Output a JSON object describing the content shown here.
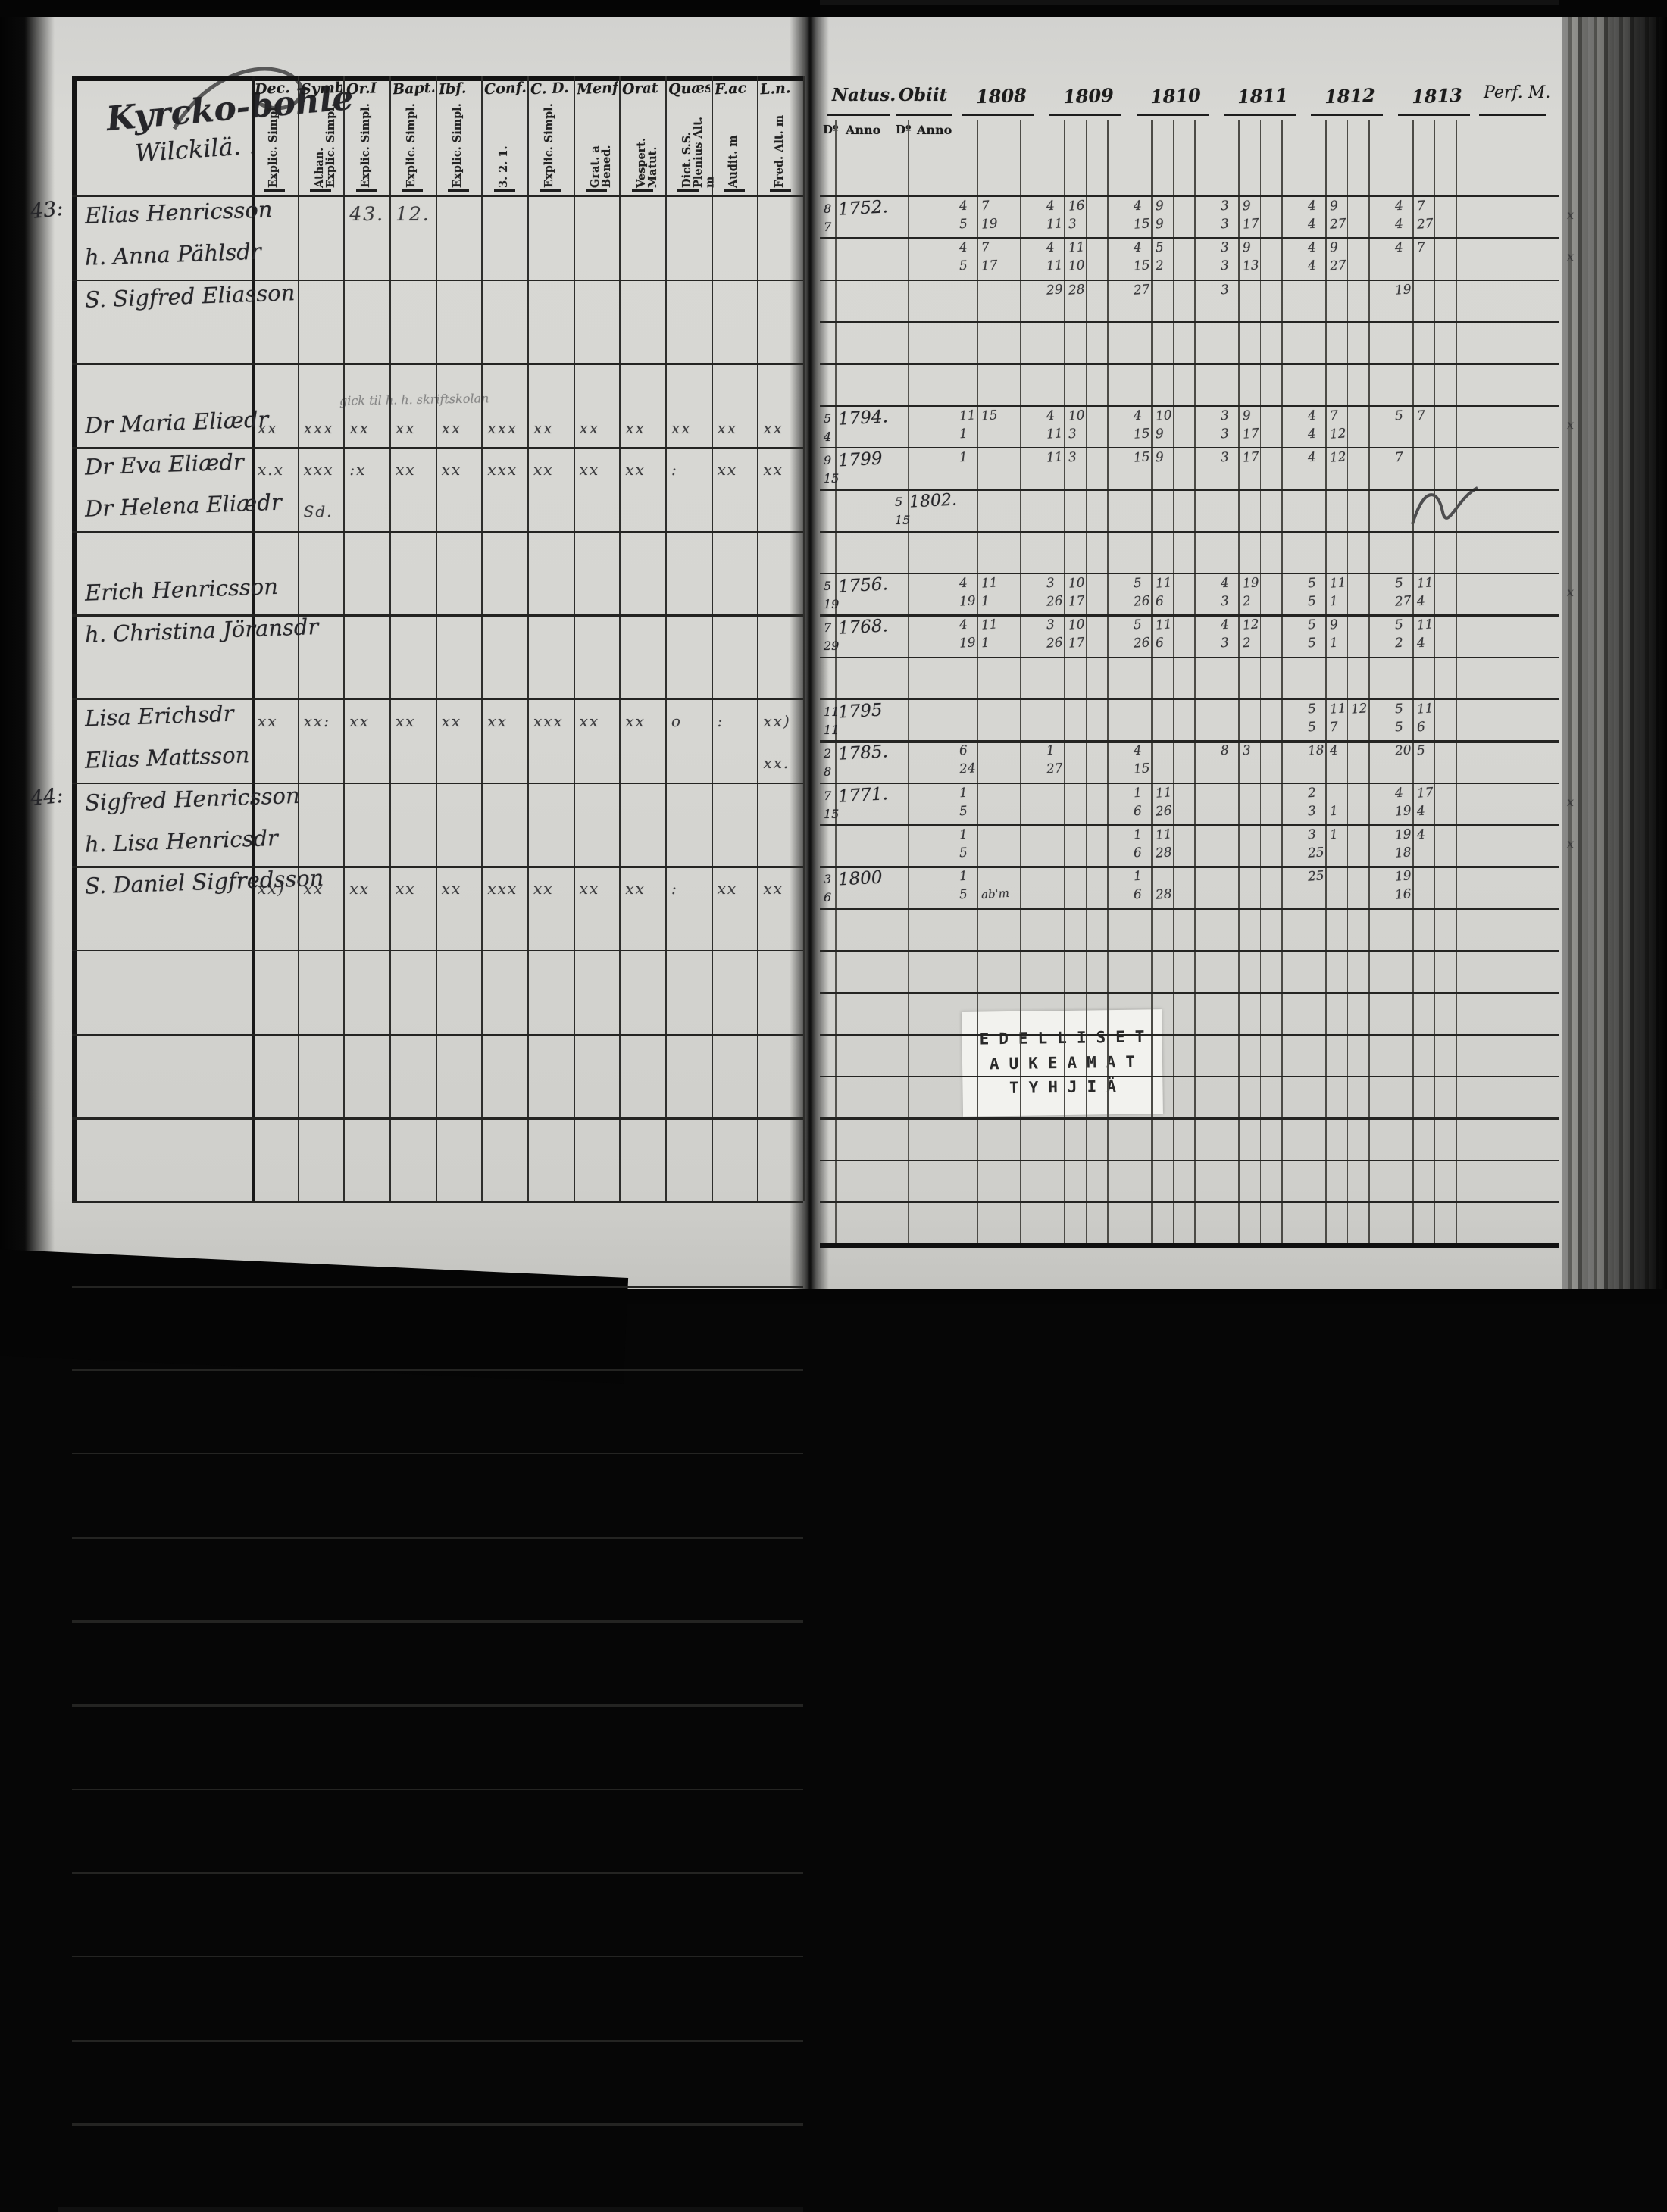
{
  "colors": {
    "paper": "#d6d6d2",
    "ink": "#1b1b1b",
    "hand": "#26262a",
    "stamp_bg": "#f2f2ee"
  },
  "left_page": {
    "title1": "Kyrcko-bohle",
    "title2": "Wilckilä. .",
    "columns": [
      {
        "abbr": "Dec.",
        "sub": "Explic. Simpl."
      },
      {
        "abbr": "Symb.",
        "sub": "Athan. Explic. Simpl."
      },
      {
        "abbr": "Or.I",
        "sub": "Explic. Simpl."
      },
      {
        "abbr": "Bapt.",
        "sub": "Explic. Simpl."
      },
      {
        "abbr": "Ibf.",
        "sub": "Explic. Simpl."
      },
      {
        "abbr": "Conf.",
        "sub": "3. 2. 1."
      },
      {
        "abbr": "C. D.",
        "sub": "Explic. Simpl."
      },
      {
        "abbr": "Menf.",
        "sub": "Grat. a Bened."
      },
      {
        "abbr": "Orat",
        "sub": "Vespert. Matut."
      },
      {
        "abbr": "Quæst.",
        "sub": "Dict. S.S. Plenius Alt. m"
      },
      {
        "abbr": "F.ac",
        "sub": "Audit. m"
      },
      {
        "abbr": "L.n.",
        "sub": "Fred. Alt. m"
      }
    ]
  },
  "right_page": {
    "natus_label": "Natus.",
    "obiit_label": "Obiit",
    "do_label": "Dº",
    "anno_label": "Anno",
    "years": [
      "1808",
      "1809",
      "1810",
      "1811",
      "1812",
      "1813"
    ],
    "perf_label": "Perf. M.",
    "stamp": [
      "EDELLISET",
      "AUKEAMAT",
      "TYHJIÄ"
    ]
  },
  "entries": [
    {
      "row": 0,
      "margin": "43:",
      "name": "Elias Henricsson",
      "left_marks": {
        "2": "43.",
        "3": "12."
      },
      "natus": {
        "d": "8",
        "y": "1752.",
        "d2": "7"
      },
      "cells": {
        "1808": {
          "t": "4 7",
          "b": "5 19"
        },
        "1809": {
          "t": "4 16",
          "b": "11 3"
        },
        "1810": {
          "t": "4 9",
          "b": "15 9"
        },
        "1811": {
          "t": "3 9",
          "b": "3 17"
        },
        "1812": {
          "t": "4 9",
          "b": "4 27"
        },
        "1813": {
          "t": "4 7",
          "b": "4 27"
        }
      },
      "edge_mark": "x"
    },
    {
      "row": 1,
      "name": "h. Anna Pählsdr",
      "cells": {
        "1808": {
          "t": "4 7",
          "b": "5 17"
        },
        "1809": {
          "t": "4 11",
          "b": "11 10"
        },
        "1810": {
          "t": "4 5",
          "b": "15 2"
        },
        "1811": {
          "t": "3 9",
          "b": "3 13"
        },
        "1812": {
          "t": "4 9",
          "b": "4 27"
        },
        "1813": {
          "t": "4 7",
          "b": ""
        }
      },
      "edge_mark": "x"
    },
    {
      "row": 2,
      "name": "S. Sigfred Eliasson",
      "cells": {
        "1809": {
          "t": "29 28",
          "b": ""
        },
        "1810": {
          "t": "27",
          "b": ""
        },
        "1811": {
          "t": "3",
          "b": ""
        },
        "1813": {
          "t": "19",
          "b": ""
        }
      }
    },
    {
      "row": 5,
      "name": "Dr Maria Eliædr",
      "note": "gick til h. h. skriftskolan",
      "left_marks": {
        "0": "xx",
        "1": "xxx",
        "2": "xx",
        "3": "xx",
        "4": "xx",
        "5": "xxx",
        "6": "xx",
        "7": "xx",
        "8": "xx",
        "9": "xx",
        "10": "xx",
        "11": "xx"
      },
      "natus": {
        "d": "5",
        "y": "1794.",
        "d2": "4"
      },
      "cells": {
        "1808": {
          "t": "11 15",
          "b": "1"
        },
        "1809": {
          "t": "4 10",
          "b": "11 3"
        },
        "1810": {
          "t": "4 10",
          "b": "15 9"
        },
        "1811": {
          "t": "3 9",
          "b": "3 17"
        },
        "1812": {
          "t": "4 7",
          "b": "4 12"
        },
        "1813": {
          "t": "5 7",
          "b": ""
        }
      },
      "edge_mark": "x"
    },
    {
      "row": 6,
      "name": "Dr Eva Eliædr",
      "left_marks": {
        "0": "x.x",
        "1": "xxx",
        "2": ":x",
        "3": "xx",
        "4": "xx",
        "5": "xxx",
        "6": "xx",
        "7": "xx",
        "8": "xx",
        "9": ":",
        "10": "xx",
        "11": "xx"
      },
      "natus": {
        "d": "9",
        "y": "1799",
        "d2": "15"
      },
      "cells": {
        "1808": {
          "t": "1",
          "b": ""
        },
        "1809": {
          "t": "11 3",
          "b": ""
        },
        "1810": {
          "t": "15 9",
          "b": ""
        },
        "1811": {
          "t": "3 17",
          "b": ""
        },
        "1812": {
          "t": "4 12",
          "b": ""
        },
        "1813": {
          "t": "7",
          "b": ""
        }
      }
    },
    {
      "row": 7,
      "name": "Dr Helena Eliædr",
      "left_marks": {
        "1": "Sd."
      },
      "obiit": {
        "d": "5",
        "y": "1802.",
        "d2": "15"
      },
      "scribble": true
    },
    {
      "row": 9,
      "name": "Erich Henricsson",
      "natus": {
        "d": "5",
        "y": "1756.",
        "d2": "19"
      },
      "cells": {
        "1808": {
          "t": "4 11",
          "b": "19 1"
        },
        "1809": {
          "t": "3 10",
          "b": "26 17"
        },
        "1810": {
          "t": "5 11",
          "b": "26 6"
        },
        "1811": {
          "t": "4 19",
          "b": "3 2"
        },
        "1812": {
          "t": "5 11",
          "b": "5 1"
        },
        "1813": {
          "t": "5 11",
          "b": "27 4"
        }
      },
      "edge_mark": "x"
    },
    {
      "row": 10,
      "name": "h. Christina Jöransdr",
      "natus": {
        "d": "7",
        "y": "1768.",
        "d2": "29"
      },
      "cells": {
        "1808": {
          "t": "4 11",
          "b": "19 1"
        },
        "1809": {
          "t": "3 10",
          "b": "26 17"
        },
        "1810": {
          "t": "5 11",
          "b": "26 6"
        },
        "1811": {
          "t": "4 12",
          "b": "3 2"
        },
        "1812": {
          "t": "5 9",
          "b": "5 1"
        },
        "1813": {
          "t": "5 11",
          "b": "2 4"
        }
      }
    },
    {
      "row": 12,
      "name": "Lisa Erichsdr",
      "left_marks": {
        "0": "xx",
        "1": "xx:",
        "2": "xx",
        "3": "xx",
        "4": "xx",
        "5": "xx",
        "6": "xxx",
        "7": "xx",
        "8": "xx",
        "9": "o",
        "10": ":",
        "11": "xx)"
      },
      "natus": {
        "d": "11",
        "y": "1795",
        "d2": "11"
      },
      "cells": {
        "1812": {
          "t": "5 11 12",
          "b": "5 7"
        },
        "1813": {
          "t": "5 11",
          "b": "5 6"
        }
      }
    },
    {
      "row": 13,
      "name": "Elias Mattsson",
      "left_marks": {
        "11": "xx."
      },
      "natus": {
        "d": "2",
        "y": "1785.",
        "d2": "8"
      },
      "cells": {
        "1808": {
          "t": "6",
          "b": "24"
        },
        "1809": {
          "t": "1",
          "b": "27"
        },
        "1810": {
          "t": "4",
          "b": "15"
        },
        "1811": {
          "t": "8 3",
          "b": ""
        },
        "1812": {
          "t": "18 4",
          "b": ""
        },
        "1813": {
          "t": "20 5",
          "b": ""
        }
      }
    },
    {
      "row": 14,
      "margin": "44:",
      "name": "Sigfred Henricsson",
      "natus": {
        "d": "7",
        "y": "1771.",
        "d2": "15"
      },
      "cells": {
        "1808": {
          "t": "1",
          "b": "5"
        },
        "1810": {
          "t": "1 11",
          "b": "6 26"
        },
        "1812": {
          "t": "2",
          "b": "3 1"
        },
        "1813": {
          "t": "4 17",
          "b": "19 4"
        }
      },
      "edge_mark": "x"
    },
    {
      "row": 15,
      "name": "h. Lisa Henricsdr",
      "cells": {
        "1808": {
          "t": "1",
          "b": "5"
        },
        "1810": {
          "t": "1 11",
          "b": "6 28"
        },
        "1812": {
          "t": "3 1",
          "b": "25"
        },
        "1813": {
          "t": "19 4",
          "b": "18"
        }
      },
      "edge_mark": "x"
    },
    {
      "row": 16,
      "name": "S. Daniel Sigfredsson",
      "left_marks": {
        "0": "xx)",
        "1": "xx",
        "2": "xx",
        "3": "xx",
        "4": "xx",
        "5": "xxx",
        "6": "xx",
        "7": "xx",
        "8": "xx",
        "9": ":",
        "10": "xx",
        "11": "xx"
      },
      "natus": {
        "d": "3",
        "y": "1800",
        "d2": "6"
      },
      "cells": {
        "1808": {
          "t": "1",
          "b": "5 ab'm"
        },
        "1810": {
          "t": "1",
          "b": "6 28"
        },
        "1812": {
          "t": "25",
          "b": ""
        },
        "1813": {
          "t": "19",
          "b": "16"
        }
      }
    }
  ]
}
